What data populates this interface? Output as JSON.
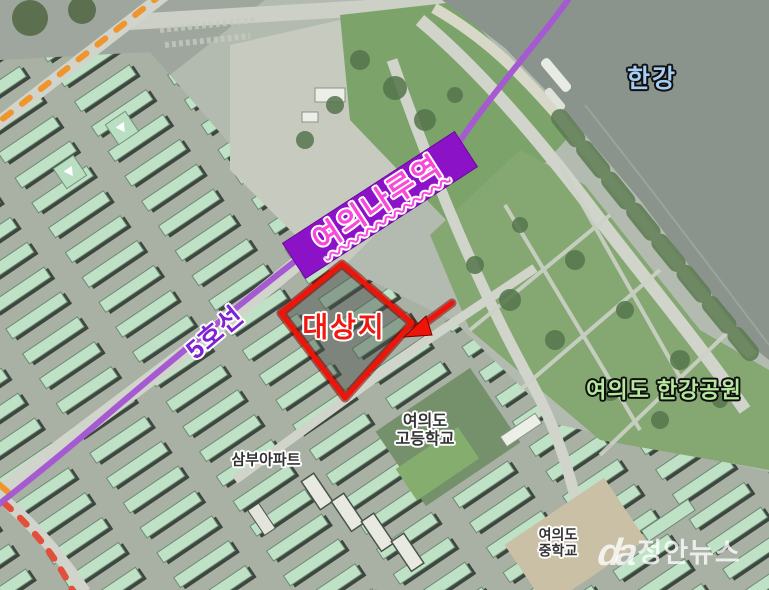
{
  "map": {
    "labels": {
      "station": "여의나루역",
      "line": "5호선",
      "site": "대상지",
      "river": "한강",
      "park": "여의도 한강공원",
      "high_school_line1": "여의도",
      "high_school_line2": "고등학교",
      "apartment": "삼부아파트",
      "middle_school_line1": "여의도",
      "middle_school_line2": "중학교"
    },
    "watermark": {
      "logo": "da",
      "text": "정안뉴스"
    },
    "colors": {
      "metro_line": "#a55ad2",
      "station_box": "#8c12c8",
      "station_text": "#f84ad8",
      "line_label_text": "#7d22d4",
      "site_outline": "#ee1508",
      "site_text": "#f01810",
      "river_text": "#a8cdf4",
      "park_text": "#b6e89e",
      "dark_label_text": "#333333",
      "orange_dash": "#f0942c",
      "red_dash": "#e2503c"
    }
  }
}
